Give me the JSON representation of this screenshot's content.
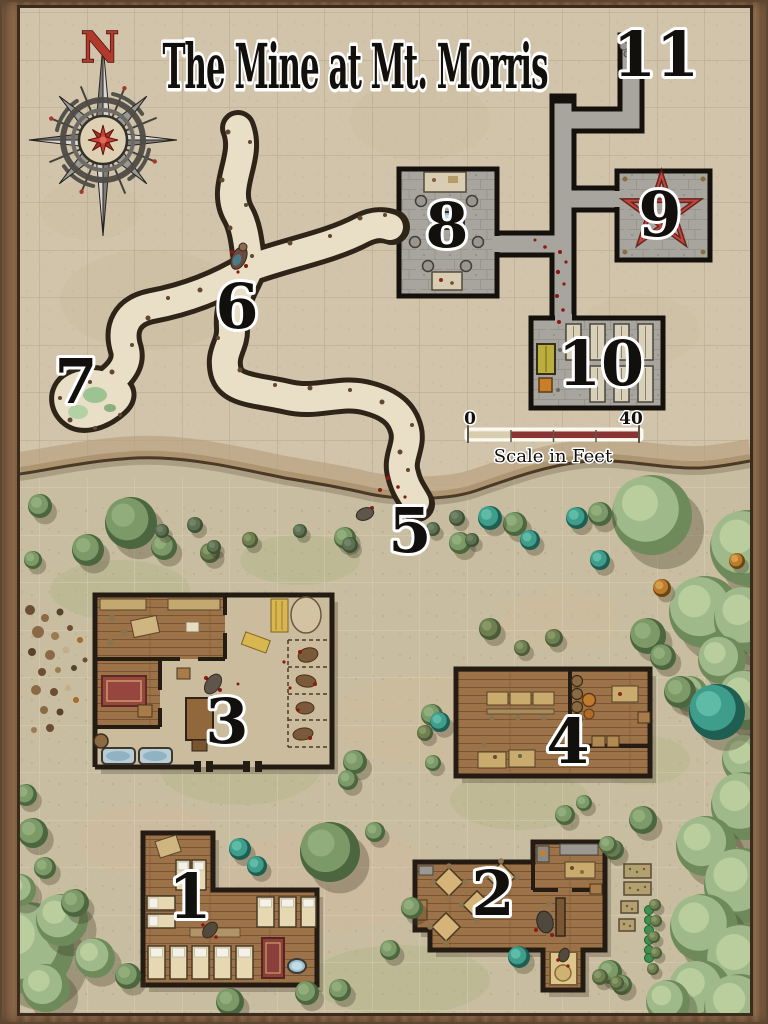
{
  "title": "The Mine at Mt. Morris",
  "compass": {
    "label": "N"
  },
  "scale_bar": {
    "start_label": "0",
    "end_label": "40",
    "caption": "Scale in Feet"
  },
  "markers": [
    {
      "label": "1",
      "x": 190,
      "y": 897
    },
    {
      "label": "2",
      "x": 493,
      "y": 894
    },
    {
      "label": "3",
      "x": 227,
      "y": 722
    },
    {
      "label": "4",
      "x": 568,
      "y": 742
    },
    {
      "label": "5",
      "x": 410,
      "y": 531
    },
    {
      "label": "6",
      "x": 237,
      "y": 307
    },
    {
      "label": "7",
      "x": 76,
      "y": 382
    },
    {
      "label": "8",
      "x": 447,
      "y": 226
    },
    {
      "label": "9",
      "x": 660,
      "y": 215
    },
    {
      "label": "10",
      "x": 601,
      "y": 364
    },
    {
      "label": "11",
      "x": 656,
      "y": 55
    }
  ],
  "colors": {
    "wood_frame": "#846346",
    "parchment": "#d1c4ab",
    "lower_ground": "#c8bda0",
    "tunnel_floor": "#e9dfc6",
    "tunnel_edge": "#2e2418",
    "stone_floor": "#a7a59d",
    "wall_black": "#14100c",
    "building_wall": "#241c13",
    "wood_floor": "#9c7248",
    "pentagram_red": "#5f1713",
    "blood_red": "#8a1a12",
    "water_blue": "#9fc0cd",
    "tree_green": "#7c9a68",
    "tree_pale": "#a0b98a",
    "tree_teal": "#3f9d8b"
  },
  "trees": [
    [
      "pale",
      652,
      515,
      40
    ],
    [
      "pale",
      748,
      548,
      38
    ],
    [
      "pale",
      705,
      612,
      36
    ],
    [
      "pale",
      748,
      620,
      34
    ],
    [
      "pale",
      722,
      660,
      24
    ],
    [
      "pale",
      748,
      700,
      30
    ],
    [
      "pale",
      690,
      694,
      18
    ],
    [
      "pale",
      748,
      760,
      26
    ],
    [
      "pale",
      745,
      806,
      34
    ],
    [
      "pale",
      706,
      846,
      30
    ],
    [
      "pale",
      742,
      886,
      38
    ],
    [
      "pale",
      704,
      928,
      34
    ],
    [
      "pale",
      746,
      964,
      40
    ],
    [
      "pale",
      700,
      992,
      32
    ],
    [
      "pale",
      740,
      1010,
      36
    ],
    [
      "pale",
      668,
      1002,
      22
    ],
    [
      "pale",
      28,
      948,
      46
    ],
    [
      "pale",
      62,
      920,
      26
    ],
    [
      "pale",
      95,
      958,
      20
    ],
    [
      "pale",
      46,
      988,
      24
    ],
    [
      "pale",
      20,
      890,
      16
    ],
    [
      "green",
      330,
      852,
      30
    ],
    [
      "green",
      131,
      523,
      26
    ],
    [
      "green",
      648,
      636,
      18
    ],
    [
      "green",
      663,
      657,
      13
    ],
    [
      "green",
      680,
      692,
      16
    ],
    [
      "green",
      88,
      550,
      16
    ],
    [
      "green",
      164,
      547,
      13
    ],
    [
      "green",
      40,
      506,
      12
    ],
    [
      "green",
      33,
      560,
      9
    ],
    [
      "green",
      345,
      538,
      11
    ],
    [
      "green",
      460,
      543,
      11
    ],
    [
      "green",
      515,
      524,
      12
    ],
    [
      "green",
      600,
      514,
      12
    ],
    [
      "green",
      375,
      832,
      10
    ],
    [
      "green",
      412,
      908,
      11
    ],
    [
      "green",
      390,
      950,
      10
    ],
    [
      "green",
      307,
      993,
      12
    ],
    [
      "green",
      230,
      1002,
      14
    ],
    [
      "green",
      128,
      976,
      13
    ],
    [
      "green",
      340,
      990,
      11
    ],
    [
      "green",
      75,
      903,
      14
    ],
    [
      "green",
      45,
      868,
      11
    ],
    [
      "green",
      26,
      795,
      11
    ],
    [
      "green",
      33,
      833,
      15
    ],
    [
      "green",
      355,
      762,
      12
    ],
    [
      "green",
      348,
      780,
      10
    ],
    [
      "green",
      432,
      715,
      11
    ],
    [
      "green",
      433,
      763,
      8
    ],
    [
      "green",
      614,
      850,
      10
    ],
    [
      "green",
      643,
      820,
      14
    ],
    [
      "green",
      608,
      845,
      9
    ],
    [
      "green",
      565,
      815,
      10
    ],
    [
      "green",
      584,
      803,
      8
    ],
    [
      "green",
      610,
      972,
      12
    ],
    [
      "green",
      622,
      985,
      10
    ],
    [
      "teal",
      717,
      712,
      28
    ],
    [
      "teal",
      600,
      560,
      10
    ],
    [
      "teal",
      490,
      518,
      12
    ],
    [
      "teal",
      530,
      540,
      10
    ],
    [
      "teal",
      577,
      518,
      11
    ],
    [
      "teal",
      240,
      849,
      11
    ],
    [
      "teal",
      257,
      866,
      10
    ],
    [
      "teal",
      440,
      722,
      10
    ],
    [
      "teal",
      519,
      957,
      11
    ],
    [
      "olive",
      210,
      553,
      10
    ],
    [
      "olive",
      250,
      540,
      8
    ],
    [
      "olive",
      490,
      629,
      11
    ],
    [
      "olive",
      522,
      648,
      8
    ],
    [
      "olive",
      554,
      638,
      9
    ],
    [
      "olive",
      425,
      733,
      8
    ],
    [
      "olive",
      655,
      905,
      6
    ],
    [
      "olive",
      656,
      921,
      6
    ],
    [
      "olive",
      654,
      937,
      6
    ],
    [
      "olive",
      656,
      953,
      6
    ],
    [
      "olive",
      653,
      969,
      6
    ],
    [
      "olive",
      600,
      977,
      8
    ],
    [
      "olive",
      617,
      983,
      7
    ],
    [
      "shrub",
      195,
      525,
      8
    ],
    [
      "shrub",
      162,
      531,
      7
    ],
    [
      "shrub",
      214,
      547,
      7
    ],
    [
      "shrub",
      300,
      531,
      7
    ],
    [
      "shrub",
      433,
      529,
      7
    ],
    [
      "shrub",
      457,
      518,
      8
    ],
    [
      "shrub",
      472,
      540,
      7
    ],
    [
      "shrub",
      350,
      545,
      8
    ],
    [
      "orange",
      662,
      588,
      9
    ],
    [
      "orange",
      737,
      561,
      8
    ]
  ]
}
